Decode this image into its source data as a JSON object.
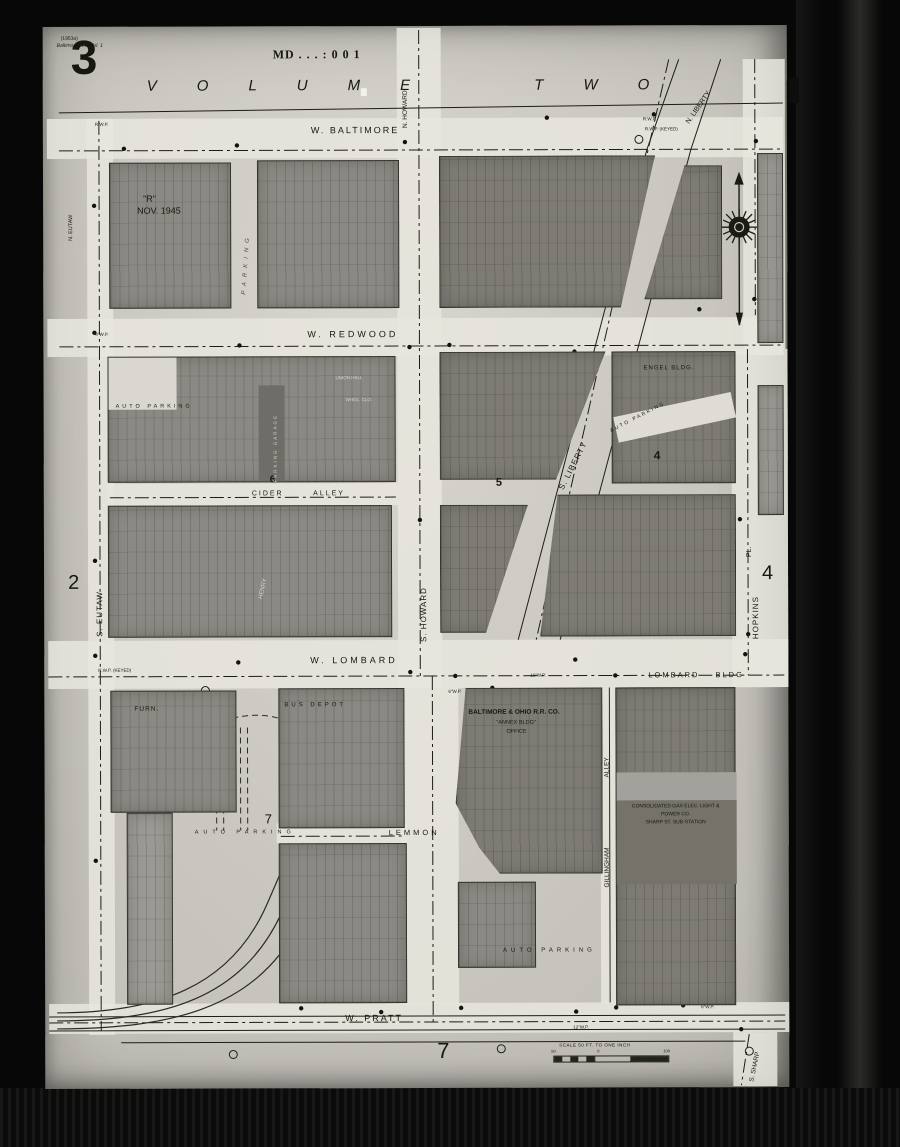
{
  "sheet": {
    "corner_note_line1": "(1953a)",
    "corner_note_line2": "Baltimore, Md. Vol. 1",
    "sheet_number": "3",
    "edition_label": "\"R\"",
    "edition_date": "NOV. 1945",
    "stamp": "MD . . . : 0 0 1",
    "volume_title": "VOLUME TWO"
  },
  "streets": {
    "w_baltimore": "W. BALTIMORE",
    "w_redwood": "W. REDWOOD",
    "cider_alley": "CIDER ALLEY",
    "w_lombard": "W. LOMBARD",
    "lemmon": "LEMMON",
    "w_pratt": "W. PRATT",
    "n_eutaw": "N. EUTAW",
    "s_eutaw": "S. EUTAW",
    "n_howard": "N. HOWARD",
    "s_howard": "S. HOWARD",
    "n_liberty": "N. LIBERTY",
    "s_liberty": "S. LIBERTY",
    "hopkins": "HOPKINS",
    "pl": "PL.",
    "gillingham": "GILLINGHAM",
    "alley": "ALLEY",
    "s_sharp": "S. SHARP"
  },
  "areas": {
    "auto_parking": "AUTO PARKING",
    "parking": "PARKING"
  },
  "buildings": {
    "engel": "ENGEL BLDG.",
    "union_hall": "UNION HALL",
    "whol_clo": "WHOL. CLO.",
    "parking_garage": "PARKING GARAGE",
    "henry": "HENRY",
    "furn": "FURN.",
    "bus_depot": "BUS DEPOT",
    "bo_line1": "BALTIMORE & OHIO R.R. CO.",
    "bo_line2": "\"ANNEX BLDG\"",
    "bo_line3": "OFFICE",
    "lombard_bldg": "LOMBARD BLDG",
    "cons_line1": "CONSOLIDATED GAS ELEC. LIGHT &",
    "cons_line2": "POWER CO.",
    "cons_line3": "SHARP ST. SUB-STATION"
  },
  "numbers": {
    "adjacent_left": "2",
    "adjacent_right": "4",
    "adjacent_bottom": "7",
    "block_4": "4",
    "block_5": "5",
    "block_6": "6",
    "block_7": "7"
  },
  "pipes": {
    "a": "R.W.P.",
    "b": "R.W.P. (KEYED)",
    "c": "6\"W.P.",
    "d": "16\"W.P.",
    "e": "8\"W.P.",
    "f": "12\"W.P."
  },
  "scale": {
    "label": "SCALE 50 FT. TO ONE INCH",
    "tick_left": "50",
    "tick_mid": "0",
    "tick_right": "100"
  },
  "icons": {
    "compass": "compass-rose-icon"
  }
}
